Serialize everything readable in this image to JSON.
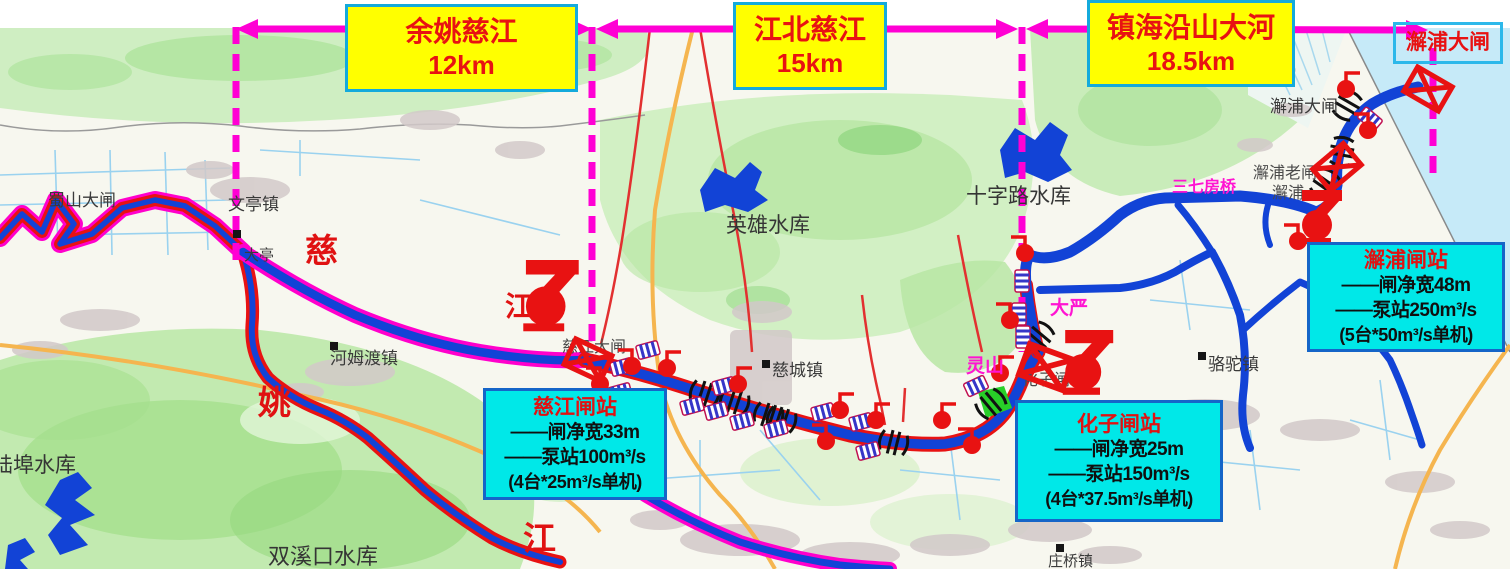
{
  "header": {
    "segments": [
      {
        "name": "余姚慈江",
        "length": "12km"
      },
      {
        "name": "江北慈江",
        "length": "15km"
      },
      {
        "name": "镇海沿山大河",
        "length": "18.5km"
      }
    ],
    "coast_gate_label": "澥浦大闸"
  },
  "stations": {
    "cijiang": {
      "title": "慈江闸站",
      "gate_width": "——闸净宽33m",
      "pump": "——泵站100m³/s",
      "units": "(4台*25m³/s单机)"
    },
    "huazi": {
      "title": "化子闸站",
      "gate_width": "——闸净宽25m",
      "pump": "——泵站150m³/s",
      "units": "(4台*37.5m³/s单机)"
    },
    "xiepu": {
      "title": "澥浦闸站",
      "gate_width": "——闸净宽48m",
      "pump": "——泵站250m³/s",
      "units": "(5台*50m³/s单机)"
    }
  },
  "rivers": {
    "ci": "慈",
    "jiang_upper": "江",
    "yao": "姚",
    "jiang_lower": "江"
  },
  "places": {
    "shushan_gate": "蜀山大闸",
    "wenting_town": "文亭镇",
    "dating": "大亭",
    "hemudu_town": "河姆渡镇",
    "cicheng_town": "慈城镇",
    "luotuo_town": "骆驼镇",
    "zhuangqiao_town": "庄桥镇",
    "lingshan": "灵山",
    "dayan": "大严",
    "sanqifang_bridge": "三七房桥",
    "xiepu_gate": "澥浦大闸",
    "xiepu_old_gate": "澥浦老闸",
    "xiepu_partial": "澥浦",
    "cijiang_gate": "慈江大闸",
    "huazi_gate": "化子闸"
  },
  "reservoirs": {
    "yingxiong": "英雄水库",
    "shizilu": "十字路水库",
    "lubu": "陆埠水库",
    "shuangxikou": "双溪口水库"
  },
  "colors": {
    "river_blue": "#1243d6",
    "casing_red": "#e81212",
    "casing_magenta": "#ff00cc",
    "divider_magenta": "#ff00d4",
    "label_yellow": "#ffff00",
    "box_cyan": "#00e8e8",
    "sea": "#c6eaf8",
    "hills": "#bce6a8",
    "road_orange": "#f5b54f"
  }
}
